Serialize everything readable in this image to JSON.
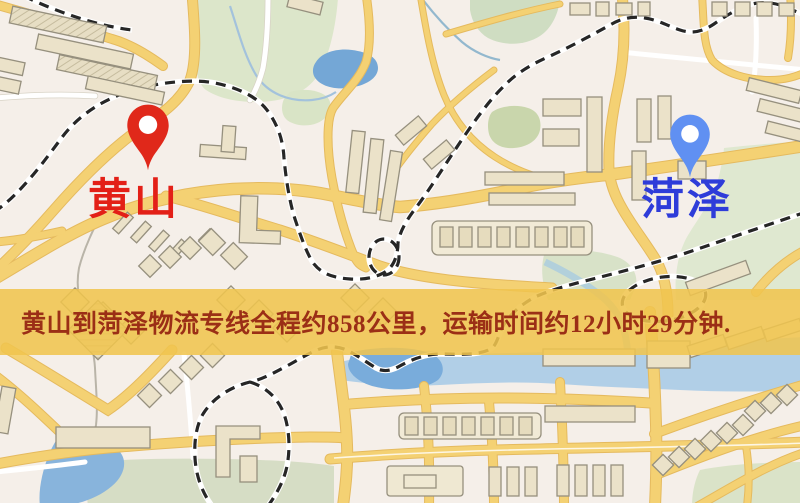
{
  "markers": {
    "origin": {
      "label": "黄山",
      "pin_color": "#e0281a",
      "label_color": "#e32017"
    },
    "destination": {
      "label": "菏泽",
      "pin_color": "#6090f2",
      "label_color": "#2e3cd9"
    }
  },
  "banner": {
    "text": "黄山到菏泽物流专线全程约858公里，运输时间约12小时29分钟.",
    "background_color": "#f0c44e",
    "text_color": "#9b2f16"
  },
  "route": {
    "origin": "黄山",
    "destination": "菏泽",
    "distance_km": "858",
    "duration": "12小时29分钟"
  },
  "map": {
    "colors": {
      "background": "#f5efe9",
      "road_major": "#f4d173",
      "road_major_edge": "#e5ba5e",
      "road_minor": "#ffffff",
      "railway": "#262626",
      "water_pond": "#77a9d8",
      "water_river": "#aacbe7",
      "park_green": "#dce6ca",
      "field_green": "#d6ddc5",
      "building_fill": "#ebe2c9",
      "building_outline": "#96907e"
    }
  }
}
